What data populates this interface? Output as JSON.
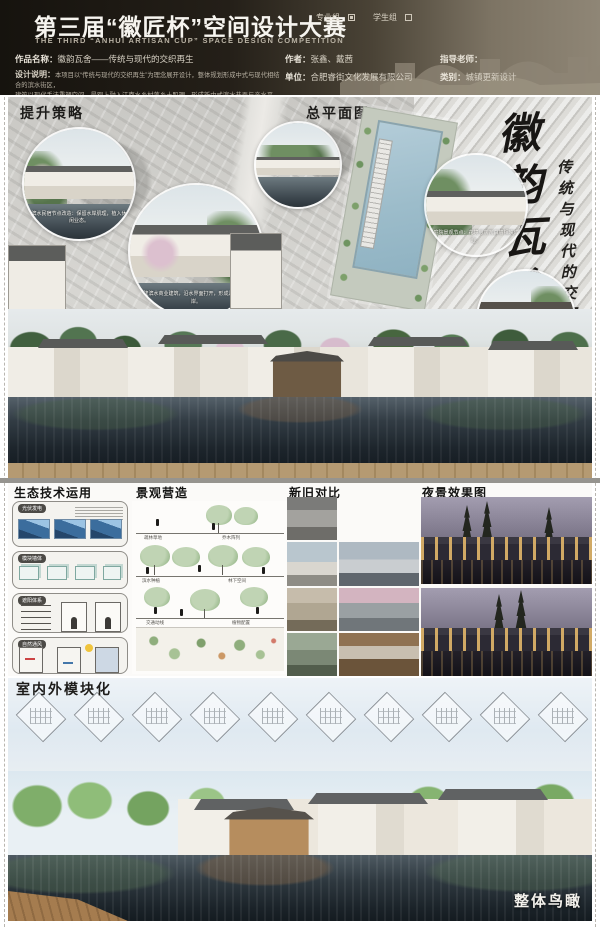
{
  "header": {
    "title": "第三届“徽匠杯”空间设计大赛",
    "subtitle": "THE THIRD “ANHUI ARTISAN CUP” SPACE DESIGN COMPETITION",
    "groups": {
      "professional": {
        "label": "专业组",
        "checked": true
      },
      "student": {
        "label": "学生组",
        "checked": false
      }
    },
    "meta": {
      "work_label": "作品名称：",
      "work_value": "徽韵瓦舍——传统与现代的交织再生",
      "author_label": "作者：",
      "author_value": "张鑫、戴茜",
      "advisor_label": "指导老师：",
      "advisor_value": "",
      "desc_label": "设计说明：",
      "desc_line1": "本项目以“传统与现代的交织再生”为理念展开设计，整体规划形成中式与现代相结合的滨水街区，",
      "desc_line2": "建筑以现代手法重塑空间，景观上融入江南水乡村落乡土肌理，形成新中式滨水巷弄与亲水平台，",
      "desc_line3": "建筑与环境相交融，营造自然与人文共生的休闲空间。",
      "unit_label": "单位：",
      "unit_value": "合肥睿街文化发展有限公司",
      "category_label": "类别：",
      "category_value": "城镇更新设计"
    }
  },
  "sections": {
    "strategy": "提升策略",
    "masterplan": "总平面图",
    "eco": "生态技术运用",
    "landscape": "景观营造",
    "contrast": "新旧对比",
    "night": "夜景效果图",
    "modules": "室内外模块化",
    "aerial": "整体鸟瞰"
  },
  "calligraphy": {
    "main": "徽韵瓦舍",
    "sub": "传统与现代的交织再生"
  },
  "captions": {
    "callout_waterfront": "滨水民宿节点改造：保留水岸肌理，植入休闲业态。",
    "callout_commerce": "新建滨水商业建筑，沿水界面打开，形成连续活力水岸。",
    "callout_courtyard": "庭院景观节点：花境与灰瓦白墙相映成趣。",
    "callout_entrance": "入口牌坊节点·绿化导入·人行游园动线",
    "eco_tags": [
      "光伏发电",
      "模块墙体",
      "遮阳体系",
      "自然通风"
    ],
    "landscape_notes": [
      "疏林草地",
      "乔木阵列",
      "滨水种植",
      "林下空间",
      "交通动线",
      "植物配置"
    ]
  }
}
